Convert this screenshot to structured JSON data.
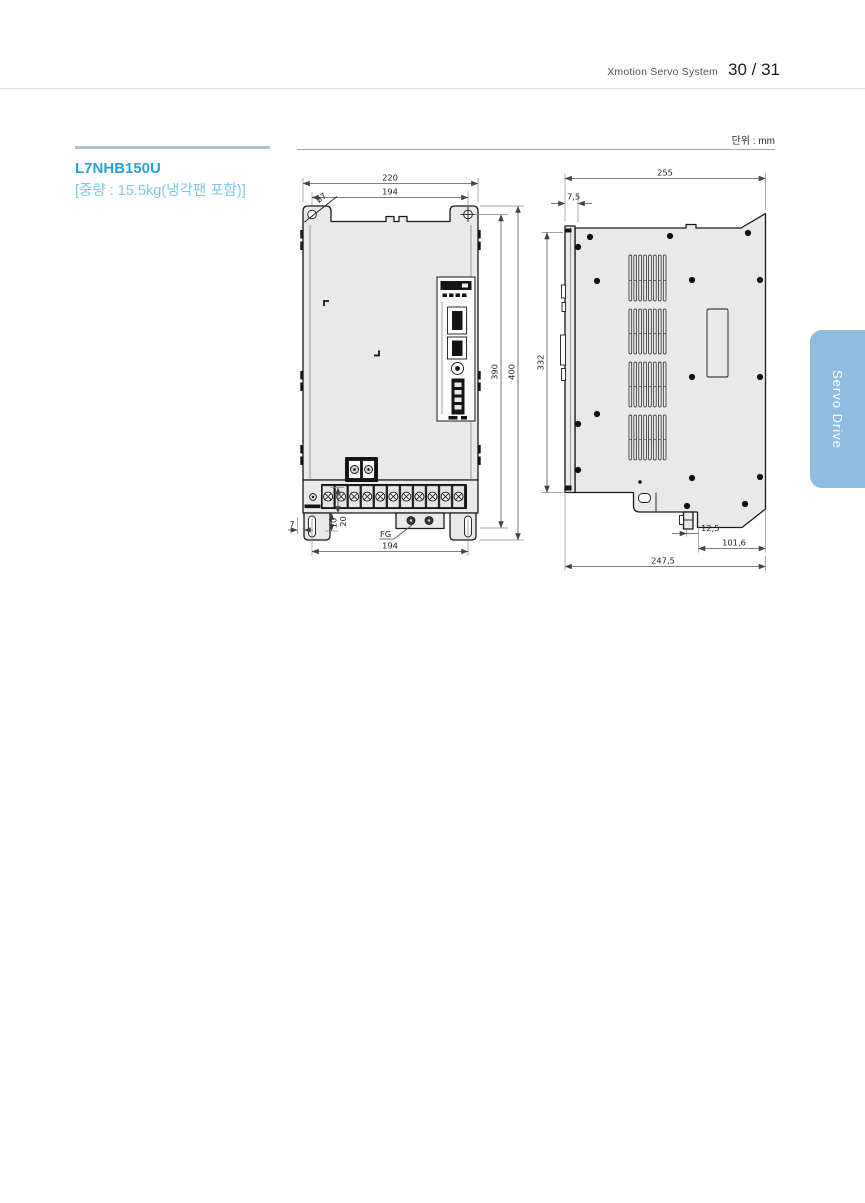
{
  "header": {
    "doc_title": "Xmotion Servo System",
    "page": "30 / 31"
  },
  "product": {
    "model": "L7NHB150U",
    "weight_note": "[중량 : 15.5kg(냉각팬 포함)]"
  },
  "unit_label": "단위 : mm",
  "side_tab": {
    "label": "Servo Drive"
  },
  "colors": {
    "accent_blue": "#2aa0db",
    "light_blue": "#7ec6ec",
    "tab_blue": "#8fbce1",
    "body_fill": "#e9e9e9"
  },
  "drawing": {
    "front_view": {
      "dims": {
        "overall_width": "220",
        "mounting_span_top": "194",
        "hole_dia": "ø7",
        "hole_pitch_vertical": "390",
        "overall_height": "400",
        "terminal_block_height": "20",
        "edge_offset": "7",
        "slot_offset": "10",
        "ground_label": "FG",
        "mounting_span_bottom": "194"
      }
    },
    "side_view": {
      "dims": {
        "overall_depth": "255",
        "top_offset": "7,5",
        "hole_pitch_vertical": "332",
        "latch_offset": "12,5",
        "lower_step_depth": "101,6",
        "base_depth": "247,5"
      }
    }
  }
}
